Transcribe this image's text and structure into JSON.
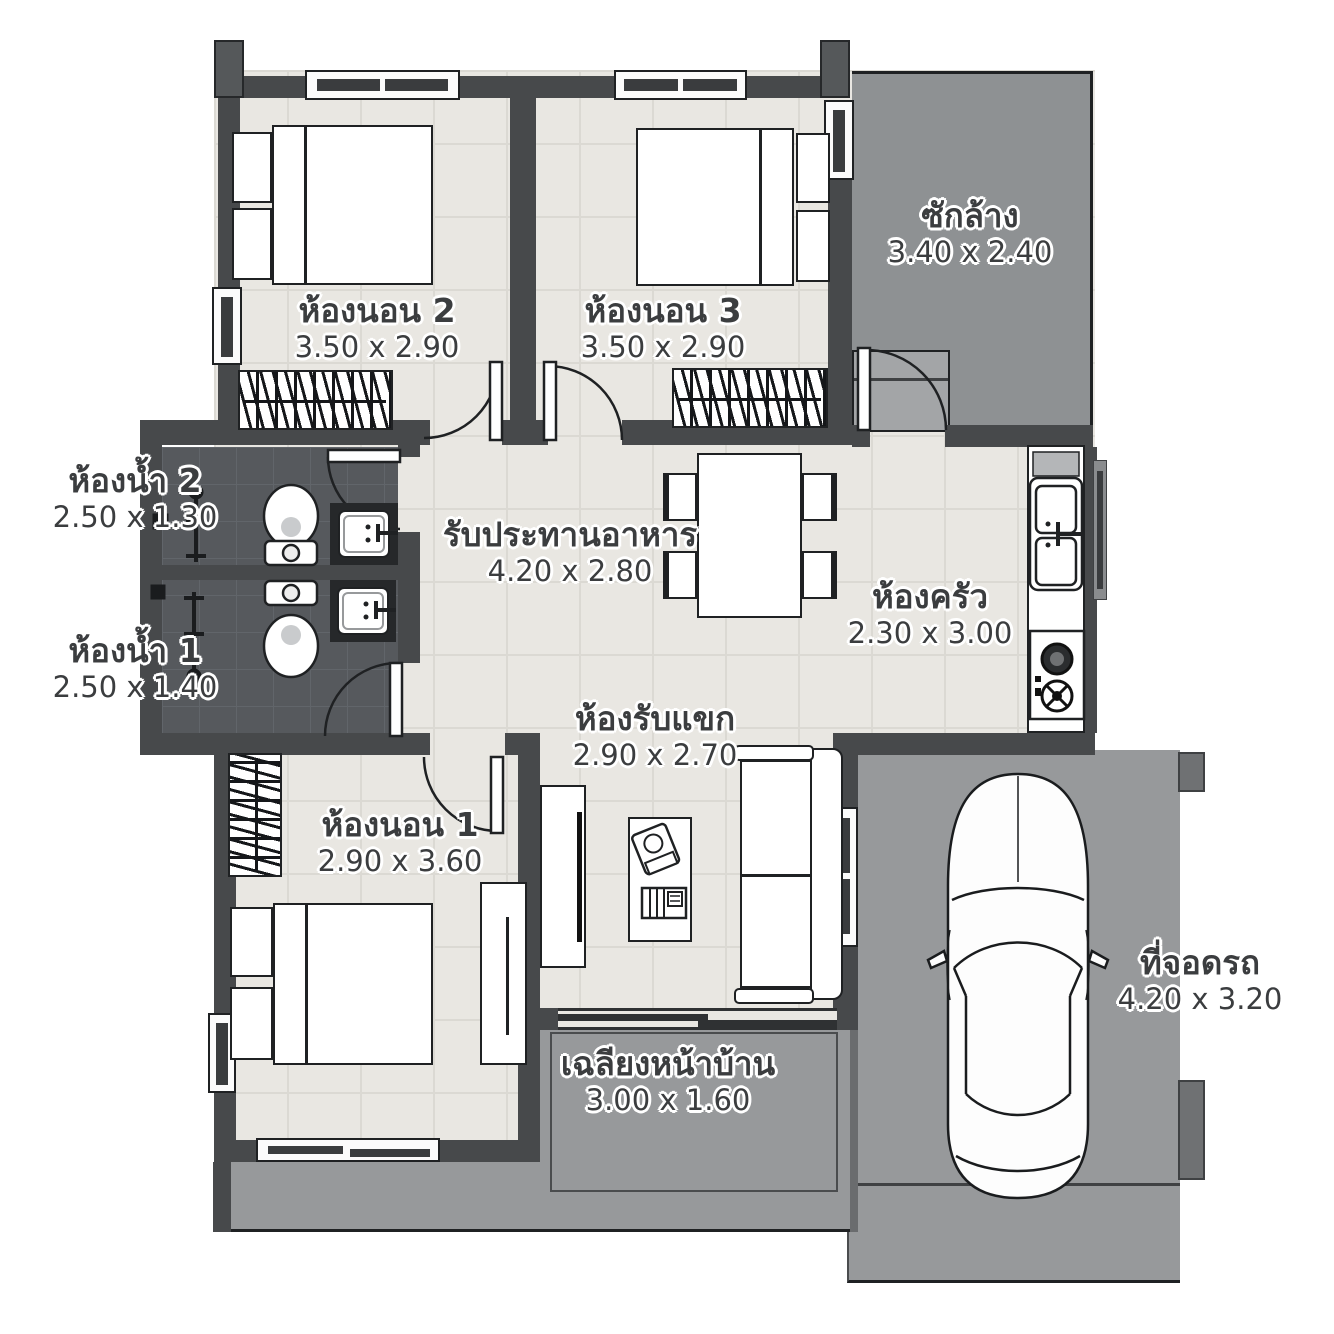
{
  "title": "house-floor-plan",
  "rooms": [
    {
      "id": "bedroom2",
      "name": "ห้องนอน 2",
      "dim": "3.50 x 2.90"
    },
    {
      "id": "bedroom3",
      "name": "ห้องนอน 3",
      "dim": "3.50 x 2.90"
    },
    {
      "id": "laundry",
      "name": "ซักล้าง",
      "dim": "3.40 x 2.40"
    },
    {
      "id": "bathroom2",
      "name": "ห้องน้ำ 2",
      "dim": "2.50 x 1.30"
    },
    {
      "id": "bathroom1",
      "name": "ห้องน้ำ 1",
      "dim": "2.50 x 1.40"
    },
    {
      "id": "dining",
      "name": "รับประทานอาหาร",
      "dim": "4.20 x 2.80"
    },
    {
      "id": "kitchen",
      "name": "ห้องครัว",
      "dim": "2.30 x 3.00"
    },
    {
      "id": "living",
      "name": "ห้องรับแขก",
      "dim": "2.90 x 2.70"
    },
    {
      "id": "bedroom1",
      "name": "ห้องนอน 1",
      "dim": "2.90 x 3.60"
    },
    {
      "id": "porch",
      "name": "เฉลียงหน้าบ้าน",
      "dim": "3.00 x 1.60"
    },
    {
      "id": "carport",
      "name": "ที่จอดรถ",
      "dim": "4.20 x 3.20"
    }
  ],
  "colors": {
    "wall": "#47494b",
    "interior_floor": "#e9e7e2",
    "bathroom_floor": "#56595d",
    "laundry_floor": "#8e9193",
    "outdoor_floor": "#97999b",
    "line": "#1f2123"
  }
}
